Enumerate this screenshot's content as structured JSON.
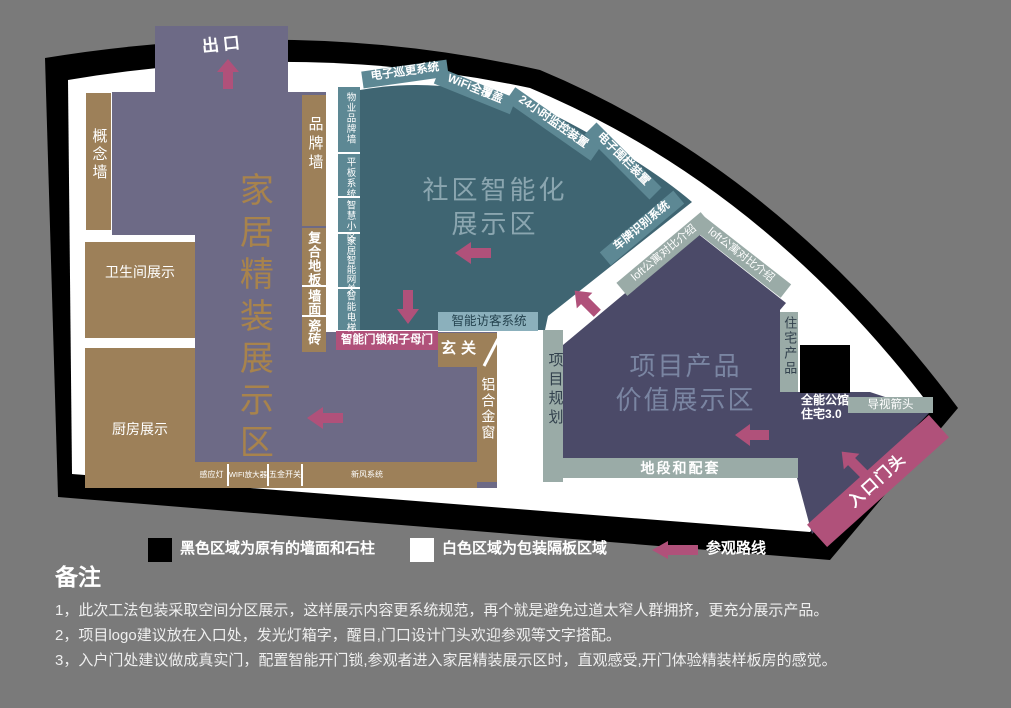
{
  "colors": {
    "background": "#7a7a7a",
    "wall_black": "#000000",
    "partition_white": "#ffffff",
    "zone_home": "#6d6a86",
    "zone_smart": "#3f6572",
    "zone_value": "#4b4a68",
    "tan_block": "#9d8059",
    "teal_strip": "#5d8894",
    "green_strip": "#9aaba7",
    "blue_strip": "#8bb0bc",
    "route_pink": "#b0517a",
    "gold_title": "#a8834c"
  },
  "floorplan": {
    "exit": "出口",
    "zones": {
      "home": "家居精装展示区",
      "smart_line1": "社区智能化",
      "smart_line2": "展示区",
      "value_line1": "项目产品",
      "value_line2": "价值展示区"
    },
    "rooms": {
      "concept_wall": "概念墙",
      "bathroom": "卫生间展示",
      "kitchen": "厨房展示",
      "entryway": "玄关",
      "brand_wall": "品牌墙",
      "composite_floor": "复合地板",
      "wall_surface": "墙面",
      "tile": "瓷砖",
      "aluminum_window": "铝合金窗"
    },
    "smart_wall_items": [
      "物业品牌墙",
      "平板系统",
      "智慧小区",
      "家居智能网关",
      "智能电梯"
    ],
    "top_strips": [
      "电子巡更系统",
      "WiFi全覆盖",
      "24小时监控装置",
      "电子围栏装置",
      "车牌识别系统",
      "loft公寓对比介绍",
      "loft公寓对比介绍"
    ],
    "value_strips": {
      "project_planning": "项目规划",
      "residential_product": "住宅产品",
      "location": "地段和配套",
      "guide_arrow": "导视箭头",
      "allin_line1": "全能公馆",
      "allin_line2": "住宅3.0",
      "entrance": "入口门头"
    },
    "door_strips": {
      "visitor": "智能访客系统",
      "doorlock": "智能门锁和子母门"
    },
    "appliance_strip": [
      "感应灯",
      "WIFI放大器",
      "五金开关",
      "新风系统"
    ]
  },
  "legend": {
    "black_label": "黑色区域为原有的墙面和石柱",
    "white_label": "白色区域为包装隔板区域",
    "route_label": "参观路线"
  },
  "notes": {
    "title": "备注",
    "lines": [
      "1，此次工法包装采取空间分区展示，这样展示内容更系统规范，再个就是避免过道太窄人群拥挤，更充分展示产品。",
      "2，项目logo建议放在入口处，发光灯箱字，醒目,门口设计门头欢迎参观等文字搭配。",
      "3，入户门处建议做成真实门，配置智能开门锁,参观者进入家居精装展示区时，直观感受,开门体验精装样板房的感觉。"
    ]
  }
}
